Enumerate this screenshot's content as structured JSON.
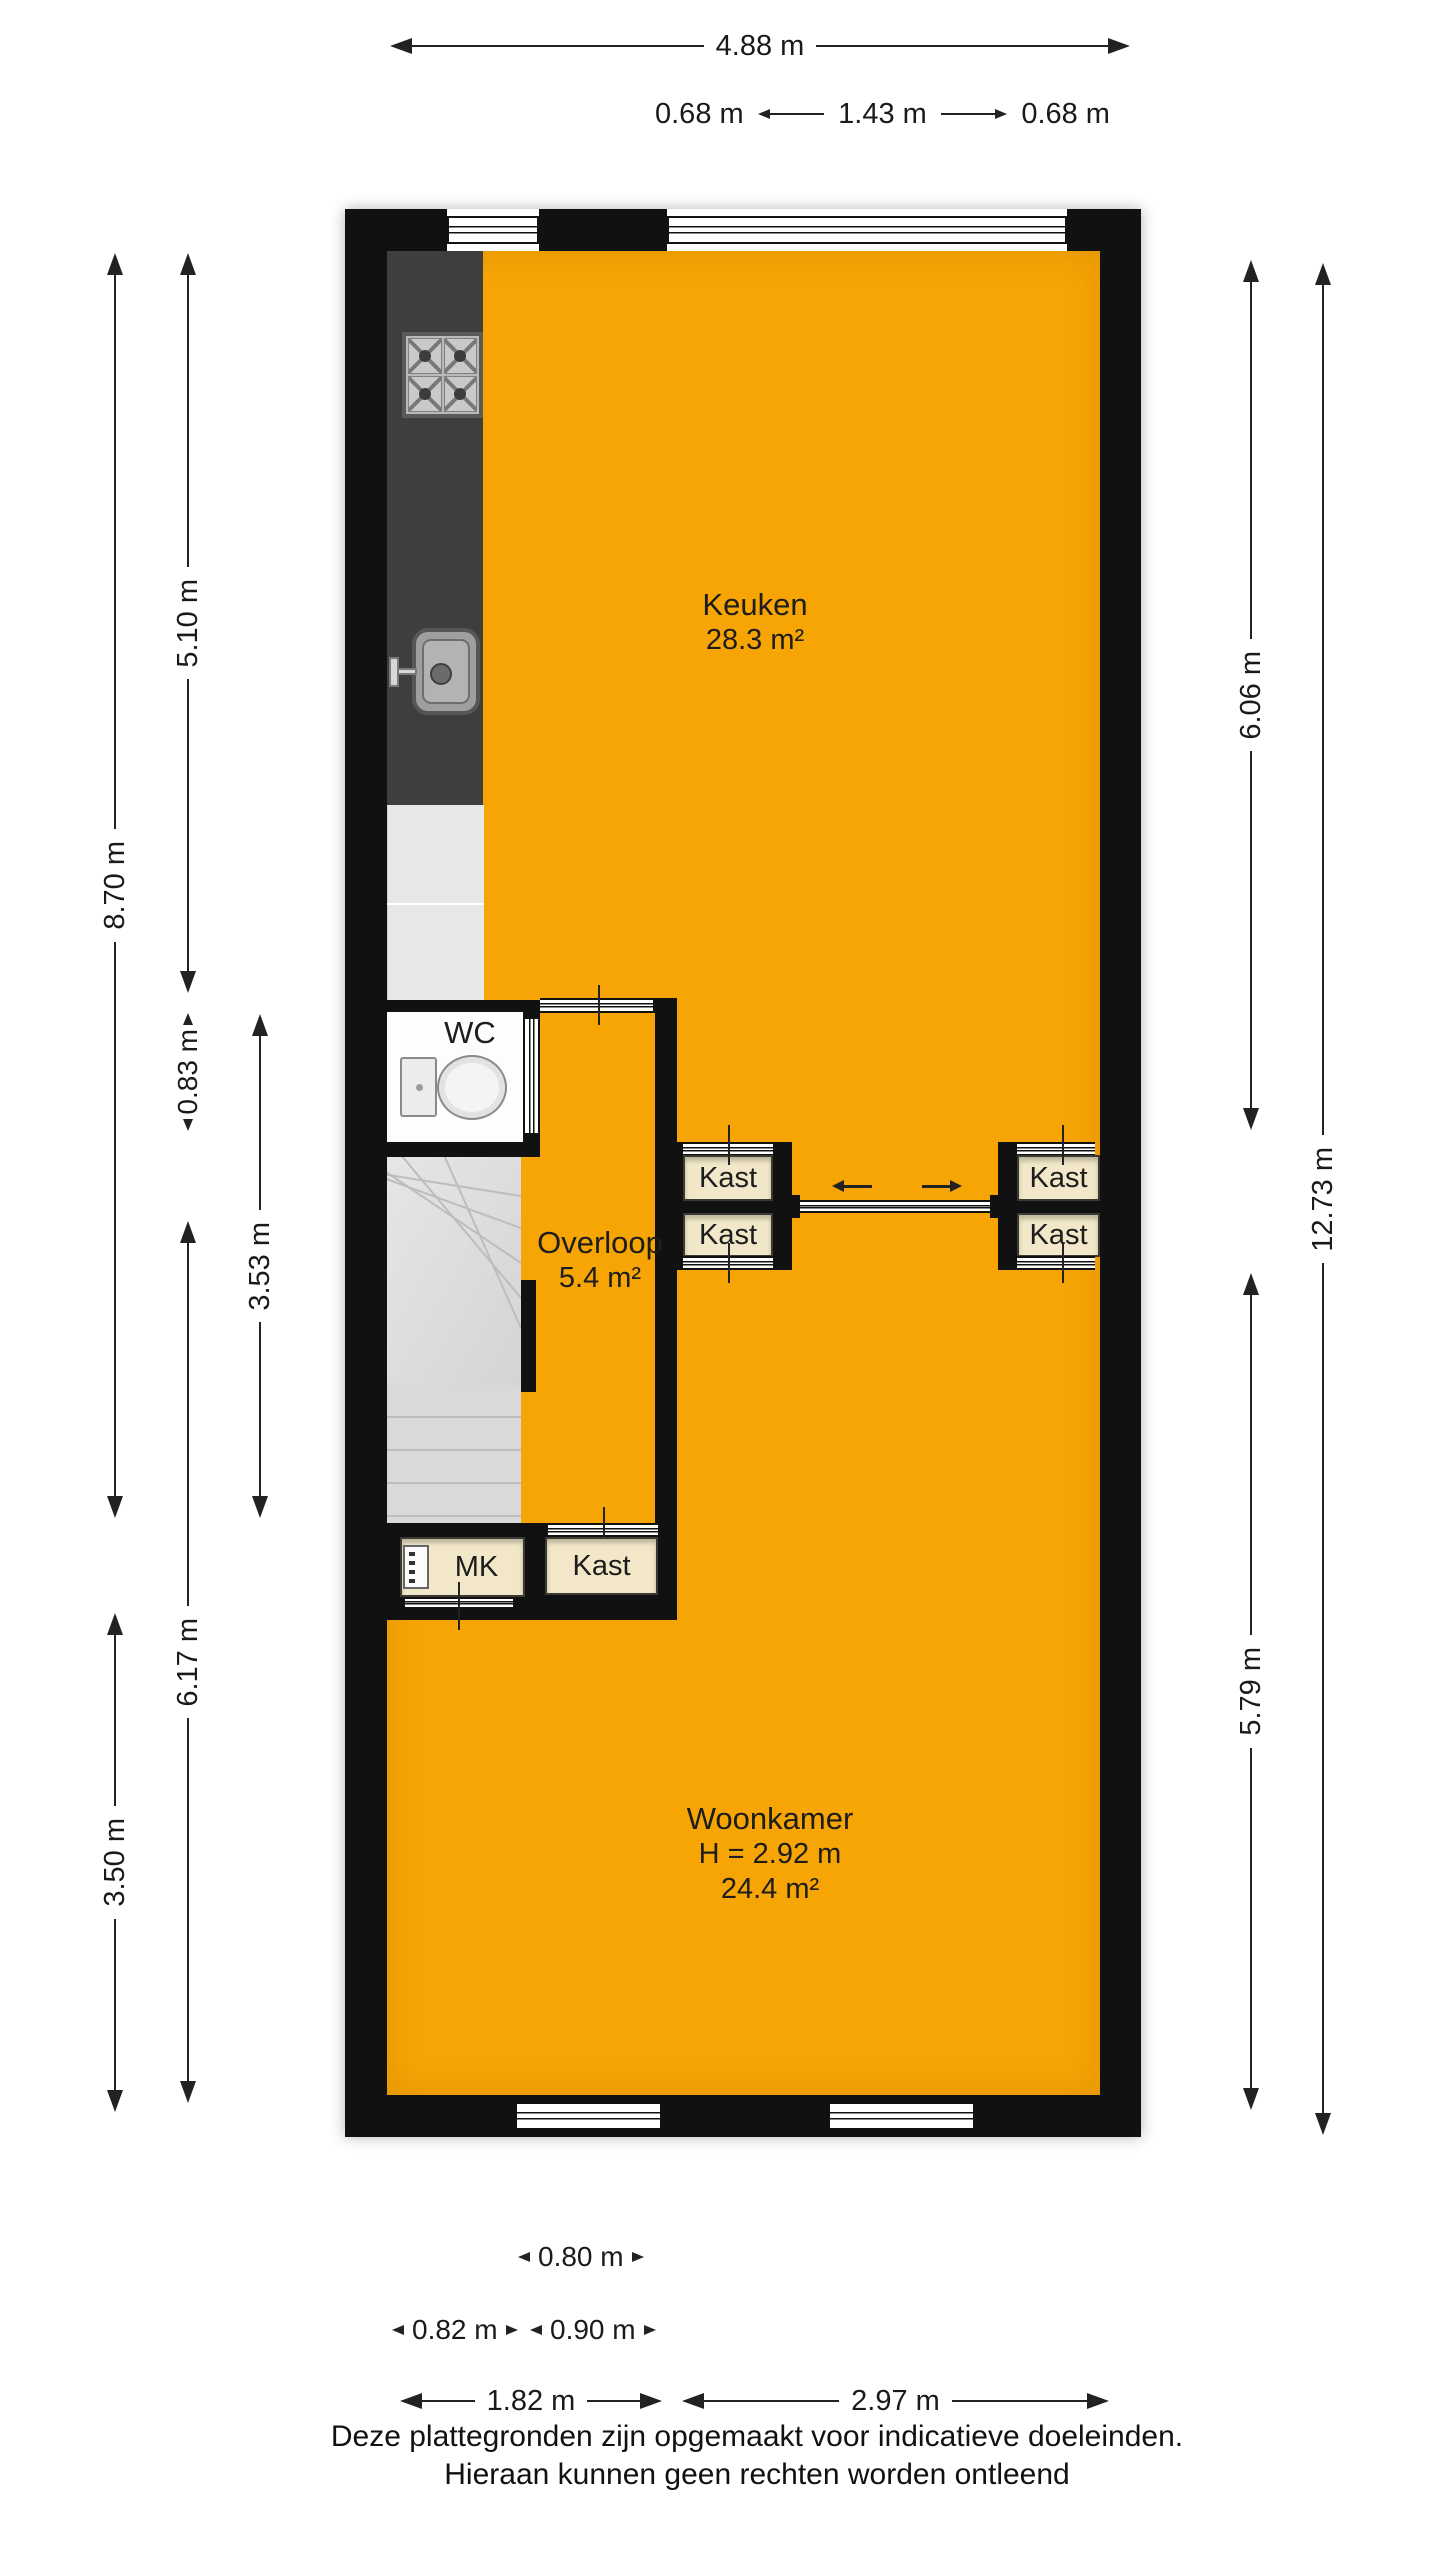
{
  "plan": {
    "rooms": {
      "keuken": {
        "name": "Keuken",
        "area": "28.3 m²"
      },
      "wc": {
        "name": "WC"
      },
      "overloop": {
        "name": "Overloop",
        "area": "5.4 m²"
      },
      "woonkamer": {
        "name": "Woonkamer",
        "ceiling_height": "H = 2.92 m",
        "area": "24.4 m²"
      },
      "kast": {
        "name": "Kast"
      },
      "mk": {
        "name": "MK"
      }
    },
    "colors": {
      "floor": "#F6A504",
      "wall": "#111111",
      "closet": "#F2E7C8",
      "counter": "#3E3E40",
      "stairs": "#DADADA",
      "appliance": "#E7E7E7"
    }
  },
  "dimensions": {
    "top": {
      "total": "4.88 m",
      "sub_left": "0.68 m",
      "sub_middle": "1.43 m",
      "sub_right": "0.68 m"
    },
    "left": {
      "col1_upper": "8.70 m",
      "col1_lower": "3.50 m",
      "col2_upper": "5.10 m",
      "col2_small": "0.83 m",
      "col2_lower": "6.17 m",
      "col3": "3.53 m"
    },
    "right": {
      "col1_upper": "6.06 m",
      "col1_lower": "5.79 m",
      "col2": "12.73 m"
    },
    "bottom": {
      "row1": "0.80 m",
      "row2_left": "0.82 m",
      "row2_right": "0.90 m",
      "row3_left": "1.82 m",
      "row3_right": "2.97 m"
    }
  },
  "footer": {
    "line1": "Deze plattegronden zijn opgemaakt voor indicatieve doeleinden.",
    "line2": "Hieraan kunnen geen rechten worden ontleend"
  }
}
